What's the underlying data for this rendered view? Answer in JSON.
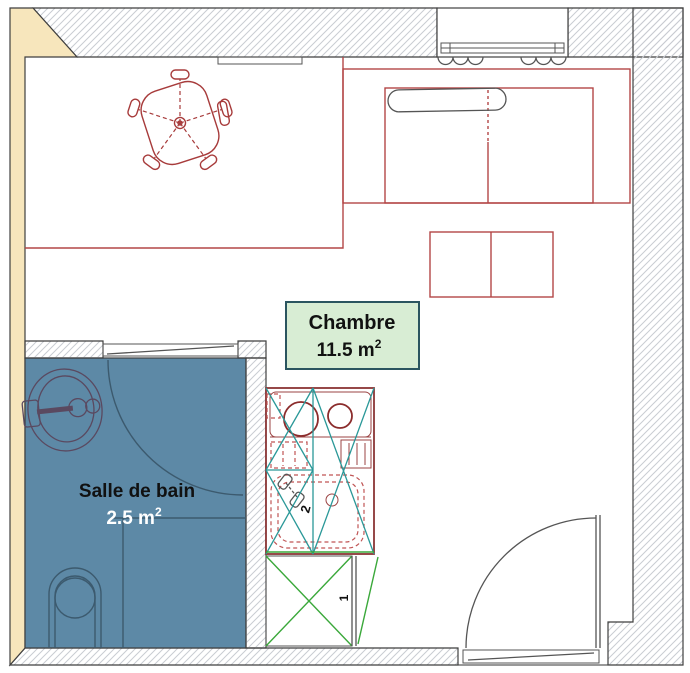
{
  "rooms": {
    "chambre": {
      "name": "Chambre",
      "area": "11.5 m",
      "area_sup": "2"
    },
    "salle_de_bain": {
      "name": "Salle de bain",
      "area": "2.5 m",
      "area_sup": "2"
    }
  },
  "marks": {
    "kitchenette": "2",
    "closet": "1"
  },
  "colors": {
    "left_wall_fill": "#f7e6bc",
    "bathroom_floor": "#5d89a6",
    "room_label_bg": "#d8edd4",
    "room_label_border": "#2b5560",
    "furniture_outline": "#b34646",
    "kitchenette_outline": "#8b3535",
    "kitchenette_brace": "#2a9898",
    "closet_cross": "#3aa83a",
    "wall_hatch_line": "#c9ccd2",
    "bathroom_line": "#3c5a6e",
    "door_line": "#555555"
  }
}
